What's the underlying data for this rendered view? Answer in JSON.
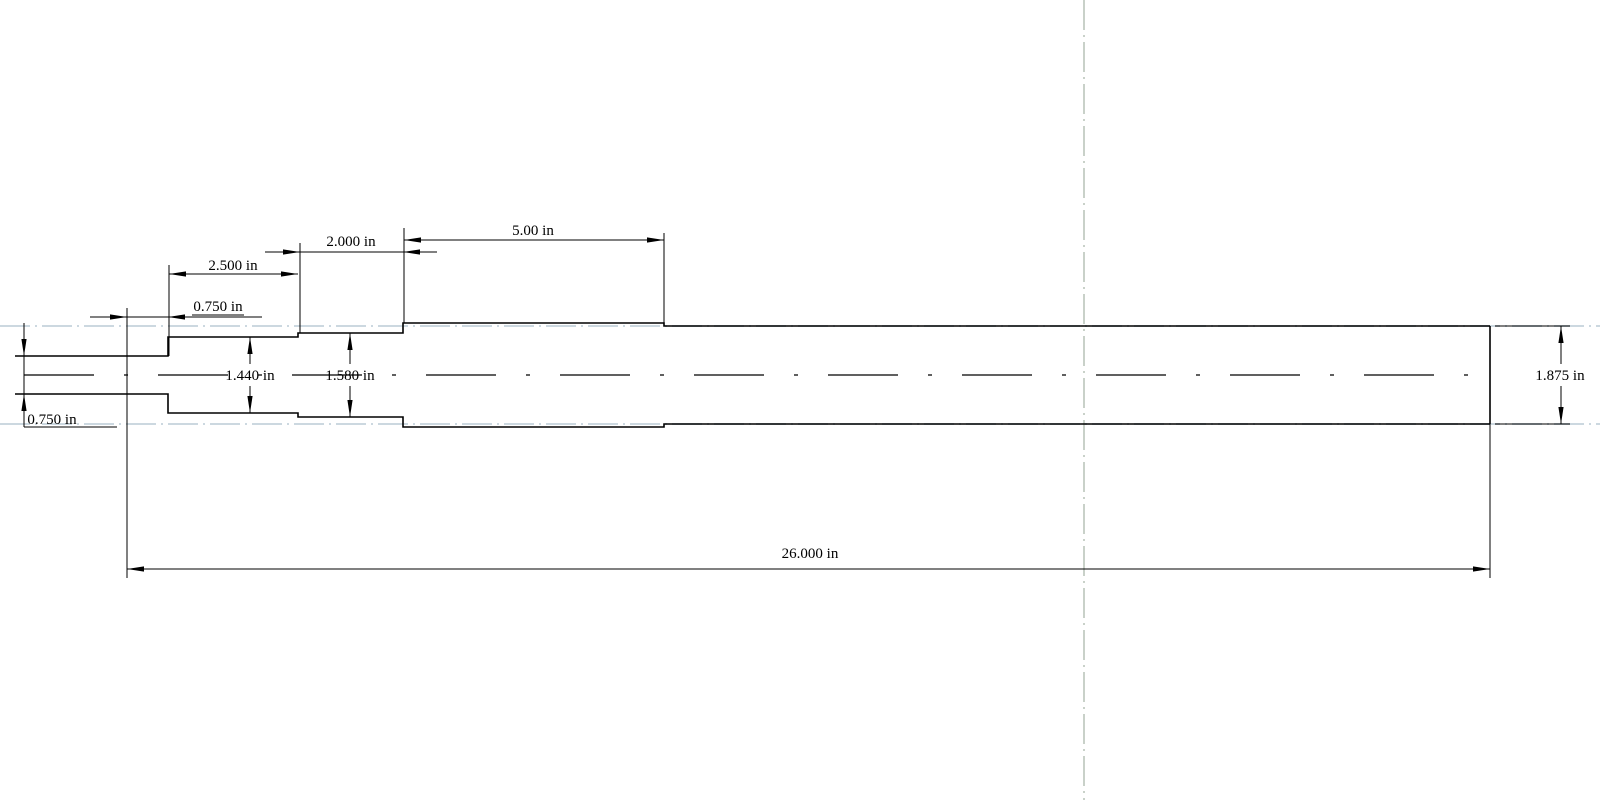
{
  "drawing": {
    "type": "engineering-drawing",
    "subject": "stepped shaft, side profile view",
    "units": "in",
    "labels": {
      "pilot_engagement_length": "0.750 in",
      "section1_length": "2.500 in",
      "section2_length": "2.000 in",
      "section3_length": "5.00 in",
      "overall_length": "26.000 in",
      "pilot_diameter": "0.750 in",
      "section1_diameter": "1.440 in",
      "section2_diameter": "1.580 in",
      "end_diameter": "1.875 in"
    },
    "segments": [
      {
        "name": "pilot-stub",
        "diameter": "0.750 in"
      },
      {
        "name": "section-1",
        "diameter": "1.440 in",
        "length": "2.500 in"
      },
      {
        "name": "section-2",
        "diameter": "1.580 in",
        "length": "2.000 in"
      },
      {
        "name": "section-3",
        "length": "5.00 in"
      },
      {
        "name": "section-4",
        "diameter": "1.875 in"
      }
    ],
    "overall_length": "26.000 in",
    "colors": {
      "line": "#000000",
      "guide_dash": "#ccd8e0",
      "sheet_center_dash": "#c9d1c9",
      "background": "#ffffff"
    }
  }
}
